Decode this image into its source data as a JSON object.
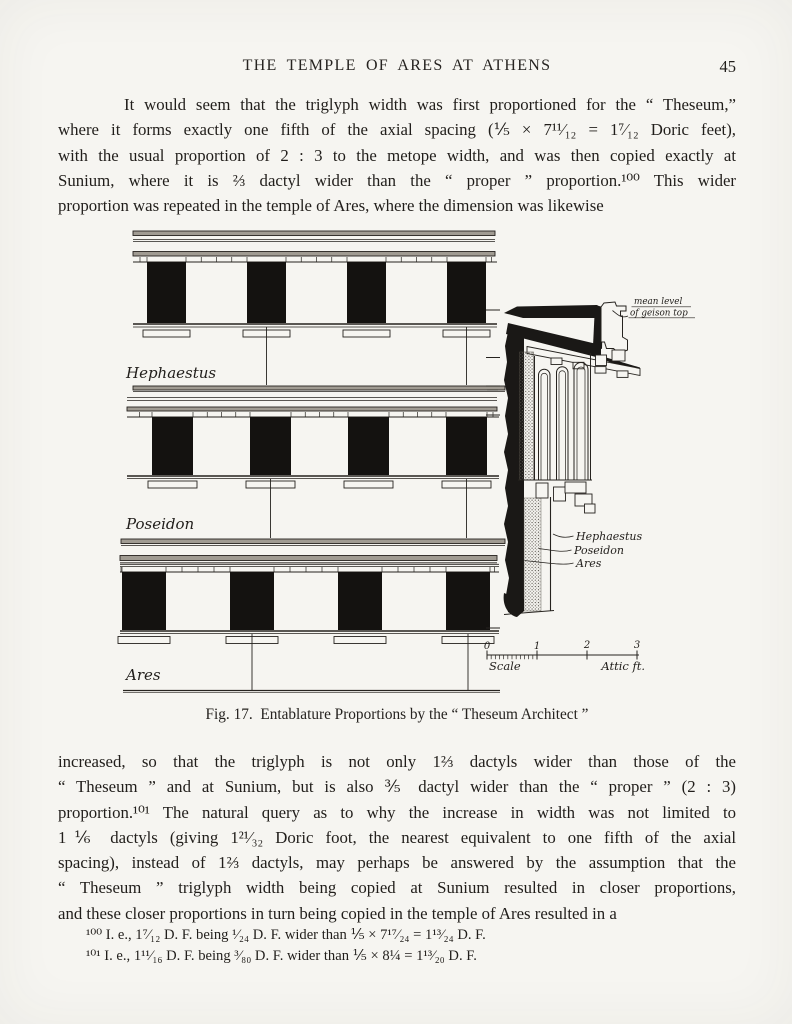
{
  "header": {
    "title": "THE TEMPLE OF ARES AT ATHENS",
    "page_number": "45"
  },
  "paragraph1": {
    "lines": [
      "It would seem that the triglyph width was first proportioned for the “ Theseum,”",
      "where it forms exactly one fifth of the axial spacing (⅕ × 7¹¹⁄₁₂ = 1⁷⁄₁₂ Doric feet),",
      "with the usual proportion of 2 : 3 to the metope width, and was then copied exactly at",
      "Sunium, where it is ⅔ dactyl wider than the “ proper ” proportion.¹⁰⁰ This wider",
      "proportion was repeated in the temple of Ares, where the dimension was likewise"
    ]
  },
  "figure": {
    "caption": "Fig. 17.  Entablature Proportions by the “ Theseum Architect ”",
    "strip_labels": [
      "Hephaestus",
      "Poseidon",
      "Ares"
    ],
    "mean_level_note": [
      "mean level",
      "of geison top"
    ],
    "section_labels": [
      "Hephaestus",
      "Poseidon",
      "Ares"
    ],
    "scale": {
      "ticks": [
        "0",
        "1",
        "2",
        "3"
      ],
      "label": "Scale",
      "unit": "Attic ft."
    }
  },
  "paragraph2": {
    "lines": [
      "increased, so that the triglyph is not only 1⅔ dactyls wider than those of the",
      "“ Theseum ” and at Sunium, but is also ⅗ dactyl wider than the “ proper ” (2 : 3)",
      "proportion.¹⁰¹ The natural query as to why the increase in width was not limited to",
      "1⅙ dactyls (giving 1²¹⁄₃₂ Doric foot, the nearest equivalent to one fifth of the axial",
      "spacing), instead of 1⅔ dactyls, may perhaps be answered by the assumption that the",
      "“ Theseum ” triglyph width being copied at Sunium resulted in closer proportions,",
      "and these closer proportions in turn being copied in the temple of Ares resulted in a"
    ]
  },
  "footnotes": [
    "¹⁰⁰ I. e., 1⁷⁄₁₂ D. F. being ¹⁄₂₄ D. F. wider than ⅕ × 7¹⁷⁄₂₄ = 1¹³⁄₂₄ D. F.",
    "¹⁰¹ I. e., 1¹¹⁄₁₆ D. F. being ³⁄₈₀ D. F. wider than ⅕ × 8¼ = 1¹³⁄₂₀ D. F."
  ],
  "colors": {
    "paper": "#f6f5f1",
    "ink": "#211e1b",
    "band_gray": "#a09b92"
  }
}
